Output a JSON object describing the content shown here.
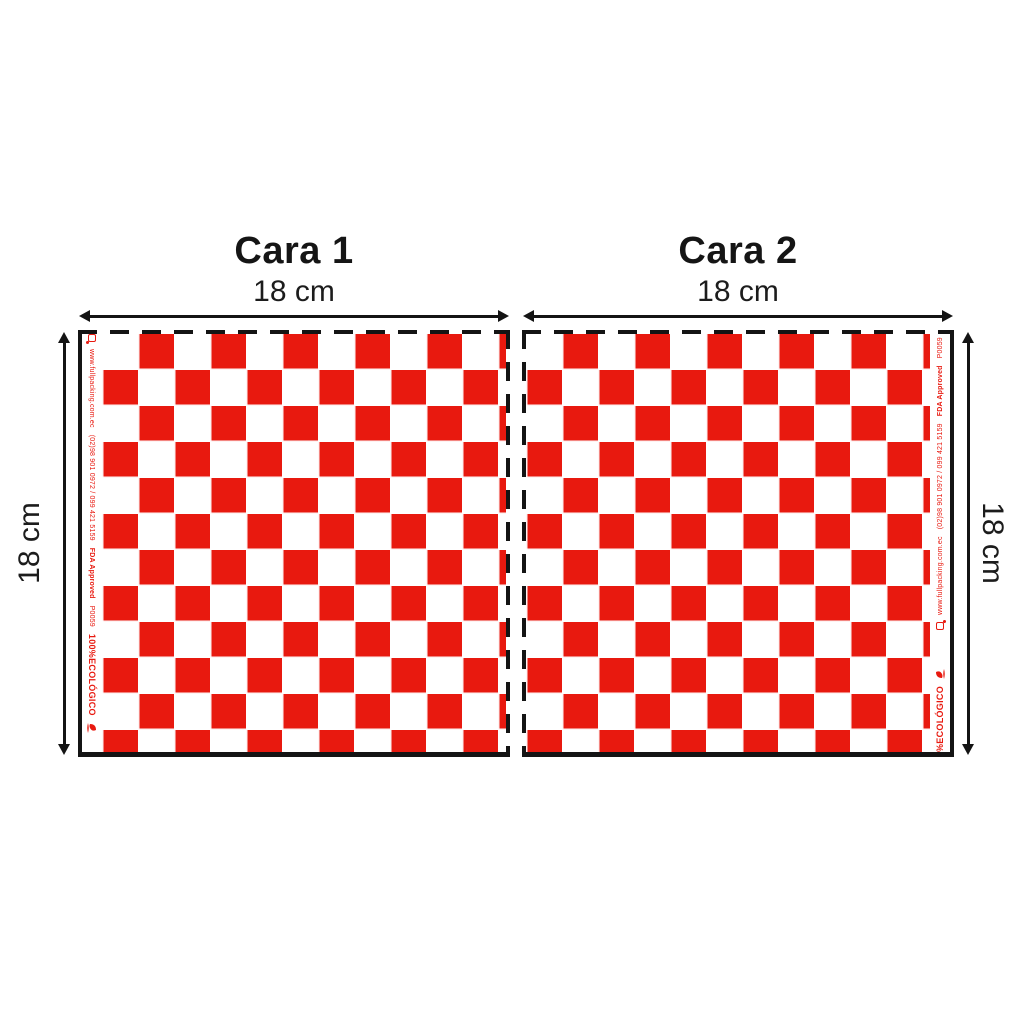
{
  "figure": {
    "panels": [
      {
        "title": "Cara 1",
        "width_label": "18 cm",
        "height_label": "18 cm"
      },
      {
        "title": "Cara 2",
        "width_label": "18 cm",
        "height_label": "18 cm"
      }
    ],
    "strip": {
      "website": "www.fullpacking.com.ec",
      "phone": "(02)98 901 0972 / 099 421 5159",
      "fda": "FDA Approved",
      "code": "P0059",
      "eco": "100%ECOLÓGICO",
      "website_partial": "www.fullpacking.c",
      "eco_partial": "%ECOLÓGICO"
    },
    "pattern": {
      "type": "checkerboard",
      "cell_cm": 1.5,
      "colors": [
        "#e8190f",
        "#ffffff"
      ]
    },
    "colors": {
      "red": "#e8190f",
      "ink": "#141414",
      "background": "#ffffff"
    }
  }
}
